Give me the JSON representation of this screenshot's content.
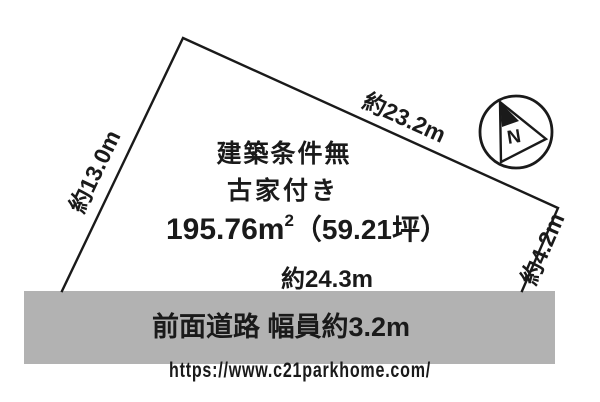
{
  "diagram": {
    "title_lines": {
      "line1": "建築条件無",
      "line2": "古家付き"
    },
    "area": {
      "value": "195.76m",
      "sup": "2",
      "tsubo": "（59.21坪）"
    },
    "edges": {
      "left_label": "約13.0m",
      "top_label": "約23.2m",
      "right_label": "約4.2m",
      "bottom_label": "約24.3m"
    },
    "road": {
      "label": "前面道路 幅員約3.2m"
    },
    "compass": {
      "north_label": "N"
    },
    "watermark": {
      "url_text": "https://www.c21parkhome.com/"
    },
    "colors": {
      "line": "#1a1a1a",
      "road_bar": "#b2b2b2",
      "watermark": "#dedede",
      "background": "#ffffff"
    }
  }
}
